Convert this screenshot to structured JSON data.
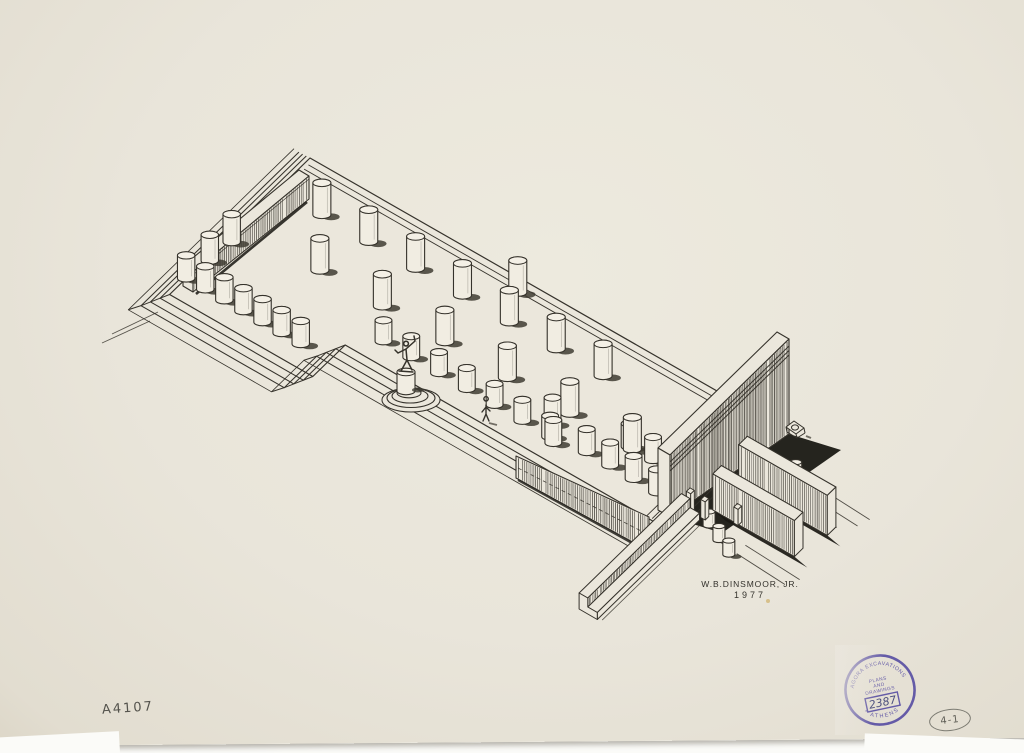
{
  "drawing": {
    "signature": "W.B.DINSMOOR, JR.",
    "year": "1977",
    "ink": "#35322b"
  },
  "pencil": {
    "catalog": "A4107",
    "sheet": "4-1"
  },
  "stamp": {
    "color": "#5b51a4",
    "arc_top": "AGORA EXCAVATIONS",
    "arc_bottom": "* ATHENS *",
    "center_lines": [
      "PLANS",
      "AND",
      "DRAWINGS"
    ],
    "number": "2387"
  },
  "paper": {
    "bg": "#e9e5da",
    "light": "#edeade",
    "edge": "#ddd7c9",
    "white": "#fbfbf8"
  },
  "scene": {
    "origin": [
      310,
      168
    ],
    "u": [
      0.868,
      0.497
    ],
    "v": [
      -0.72,
      0.7
    ],
    "ink": "#35322b",
    "paper_fill": "#ebe7dc",
    "shadow": "#1a1914",
    "blob": "#3f3c33",
    "floor": 10,
    "platform": [
      [
        0,
        0
      ],
      [
        523,
        0
      ],
      [
        523,
        150
      ],
      [
        165,
        150
      ],
      [
        165,
        195
      ],
      [
        0,
        195
      ]
    ],
    "step_offsets": [
      0,
      6,
      12,
      18,
      26
    ],
    "step_heights": [
      10,
      7.5,
      5,
      2.5,
      0
    ],
    "back_lines": [
      7,
      13
    ],
    "east_inner_lines": [
      517,
      511
    ],
    "west_wall": {
      "topA": [
        309,
        176
      ],
      "topB": [
        193,
        272
      ],
      "thick": [
        -10,
        -6
      ],
      "botA": [
        309,
        199
      ],
      "botB": [
        193,
        292
      ],
      "shadowA": [
        307,
        202
      ],
      "shadowB": [
        196,
        294
      ]
    },
    "east_wall": {
      "topA": [
        777,
        332
      ],
      "topB": [
        658,
        448
      ],
      "thick": [
        12,
        7
      ],
      "faceBotA": [
        789,
        434
      ],
      "faceBotB": [
        670,
        517
      ],
      "bands": [
        7,
        11.5,
        16
      ],
      "shadow_off": [
        52,
        16
      ]
    },
    "podium": {
      "topA": [
        516,
        456
      ],
      "topB": [
        649,
        517
      ],
      "botA": [
        516,
        478
      ],
      "botB": [
        649,
        551
      ]
    },
    "annex_walls": [
      {
        "a0": 547,
        "a1": 649,
        "b0": 52,
        "b1": 64,
        "h": 40
      },
      {
        "a0": 547,
        "a1": 641,
        "b0": 88,
        "b1": 100,
        "h": 36
      }
    ],
    "annex_ground_lines": [
      [
        582,
        24,
        668,
        28
      ],
      [
        580,
        36,
        664,
        40
      ],
      [
        584,
        48,
        650,
        52
      ],
      [
        597,
        115,
        662,
        118
      ],
      [
        597,
        127,
        655,
        130
      ]
    ],
    "found_ext": [
      [
        158,
        312,
        112,
        334
      ],
      [
        150,
        321,
        102,
        343
      ]
    ],
    "ramp": {
      "a0": 524,
      "a1": 534,
      "a2": 545,
      "b0": 116,
      "b1": 258,
      "h1": 16,
      "h2": 7
    },
    "piers": [
      [
        529,
        110,
        20
      ],
      [
        544,
        108,
        18
      ],
      [
        572,
        96,
        16
      ]
    ],
    "columns": [
      {
        "name": "interior",
        "floor": 10,
        "r": 9,
        "h": 32,
        "items": [
          [
            51,
            45
          ],
          [
            105,
            45
          ],
          [
            159,
            45
          ],
          [
            213,
            45
          ],
          [
            267,
            45
          ],
          [
            321,
            45
          ],
          [
            375,
            45
          ],
          [
            91,
            96
          ],
          [
            163,
            96
          ],
          [
            235,
            96
          ],
          [
            307,
            96
          ],
          [
            379,
            96
          ],
          [
            451,
            96
          ],
          [
            251,
            14
          ]
        ]
      },
      {
        "name": "wing",
        "floor": 10,
        "r": 8.7,
        "h": 23,
        "items": [
          [
            0,
            172
          ],
          [
            22,
            172
          ],
          [
            44,
            172
          ],
          [
            66,
            172
          ],
          [
            88,
            172
          ],
          [
            110,
            172
          ],
          [
            132,
            172
          ],
          [
            4,
            144,
            26
          ],
          [
            6,
            116,
            28
          ]
        ]
      },
      {
        "name": "recess",
        "floor": 10,
        "r": 8.4,
        "h": 21,
        "items": [
          [
            190,
            127
          ],
          [
            222,
            127
          ],
          [
            254,
            127
          ],
          [
            286,
            127
          ],
          [
            318,
            127
          ],
          [
            350,
            127
          ],
          [
            382,
            127
          ]
        ]
      },
      {
        "name": "se-wing",
        "floor": 10,
        "r": 8.4,
        "h": 23,
        "items": [
          [
            374,
            114,
            26
          ],
          [
            389,
            131
          ],
          [
            420,
            122
          ],
          [
            447,
            122
          ],
          [
            474,
            122
          ],
          [
            501,
            122
          ],
          [
            447,
            95
          ],
          [
            474,
            95
          ],
          [
            501,
            95
          ],
          [
            517,
            68,
            26
          ]
        ]
      },
      {
        "name": "annex",
        "floor": 0,
        "r": 6,
        "h": 14,
        "items": [
          [
            556,
            116
          ],
          [
            574,
            124
          ],
          [
            592,
            132
          ],
          [
            582,
            27
          ]
        ]
      }
    ],
    "monument": {
      "rings": [
        [
          411,
          400,
          29,
          12
        ],
        [
          411,
          398,
          24,
          9.5
        ],
        [
          410,
          396,
          18,
          7
        ],
        [
          409,
          393,
          12,
          4.8
        ]
      ],
      "pedestal": {
        "x": 406,
        "base": 391,
        "r": 9,
        "h": 19
      },
      "statue_path": "M406,346 a2.4,2.4 0 1 1 0.1,0 M406,349 l9,-8 l-1,-5 M406,349 l-8,4 l-3,-3 M406,349 l1,11 M407,360 l-6,11 M407,360 l5,10 M399,371 l14,1",
      "shadow": [
        418,
        390,
        6,
        2.5
      ]
    },
    "figure": {
      "path": "M486,401 a2.2,2.2 0 1 1 0.1,0 M486,405 l0,9 M486,407 l-4,5 M486,407 l4,4 M486,414 l-3,7 M486,414 l3,7",
      "shadow": [
        489,
        423,
        497,
        425
      ]
    },
    "block": {
      "cx": 795,
      "cy": 428
    }
  }
}
